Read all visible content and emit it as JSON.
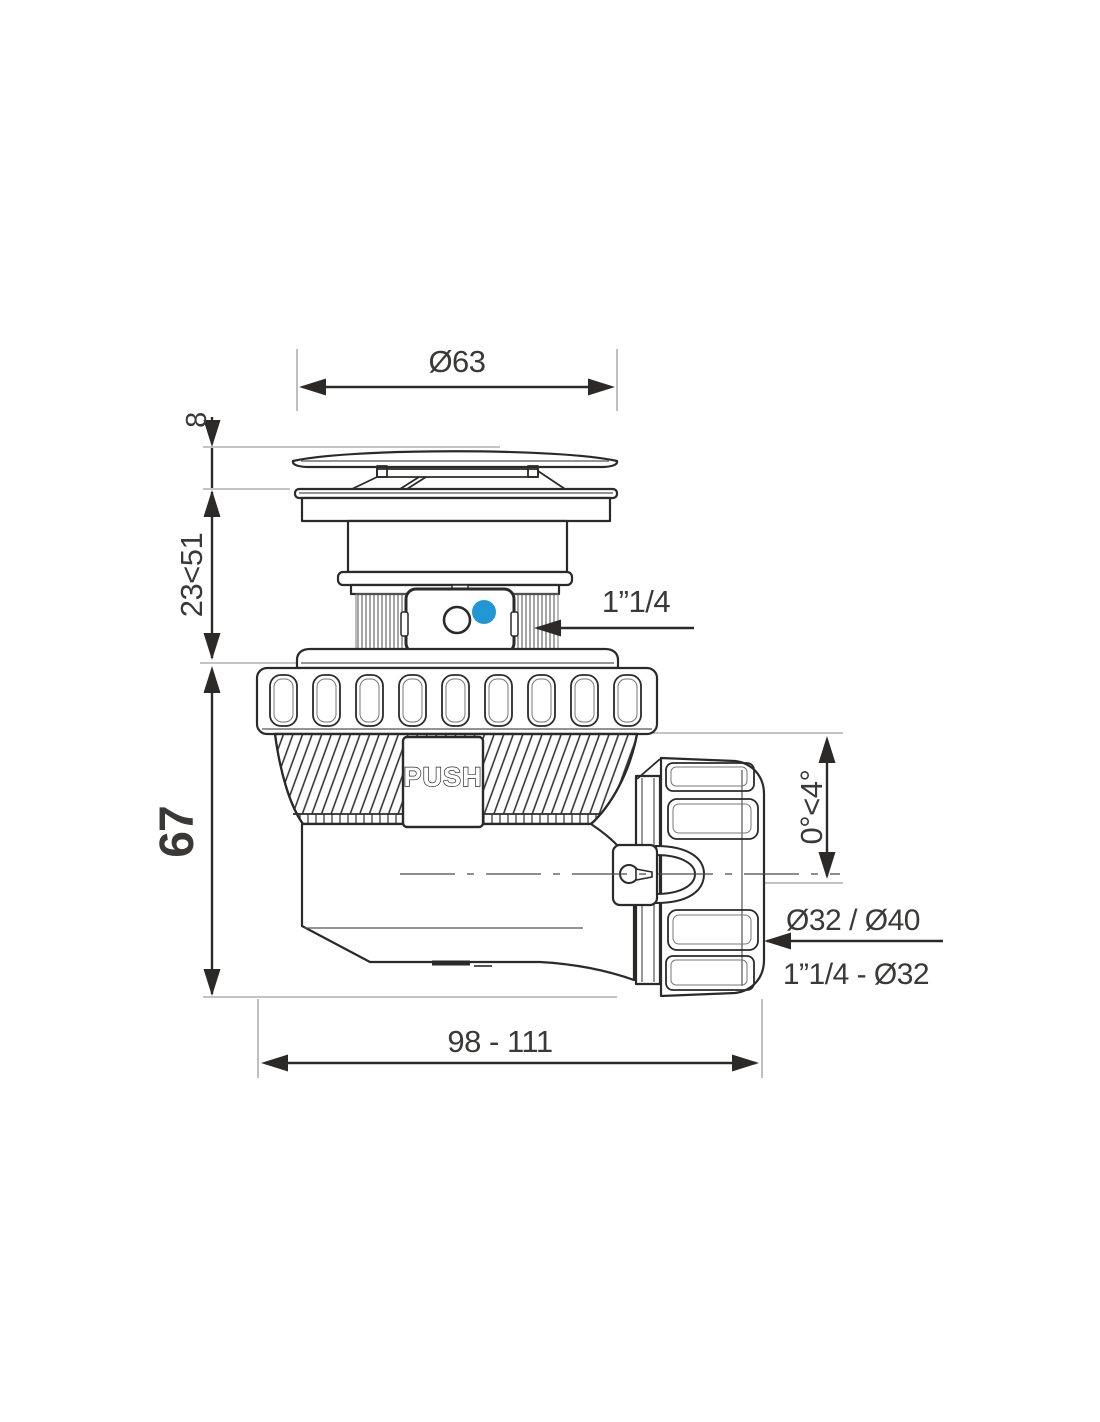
{
  "labels": {
    "cap_diameter": "Ø63",
    "cap_height": "8",
    "adjust_height": "23<51",
    "body_height": "67",
    "inlet_thread": "1”1/4",
    "tilt_range": "0°<4°",
    "outlet_sizes": "Ø32 / Ø40",
    "outlet_thread": "1”1/4 - Ø32",
    "overall_length": "98 - 111",
    "push": "PUSH"
  },
  "colors": {
    "line": "#2b2a29",
    "label_text": "#3a3938",
    "accent_blue": "#2297d5"
  }
}
